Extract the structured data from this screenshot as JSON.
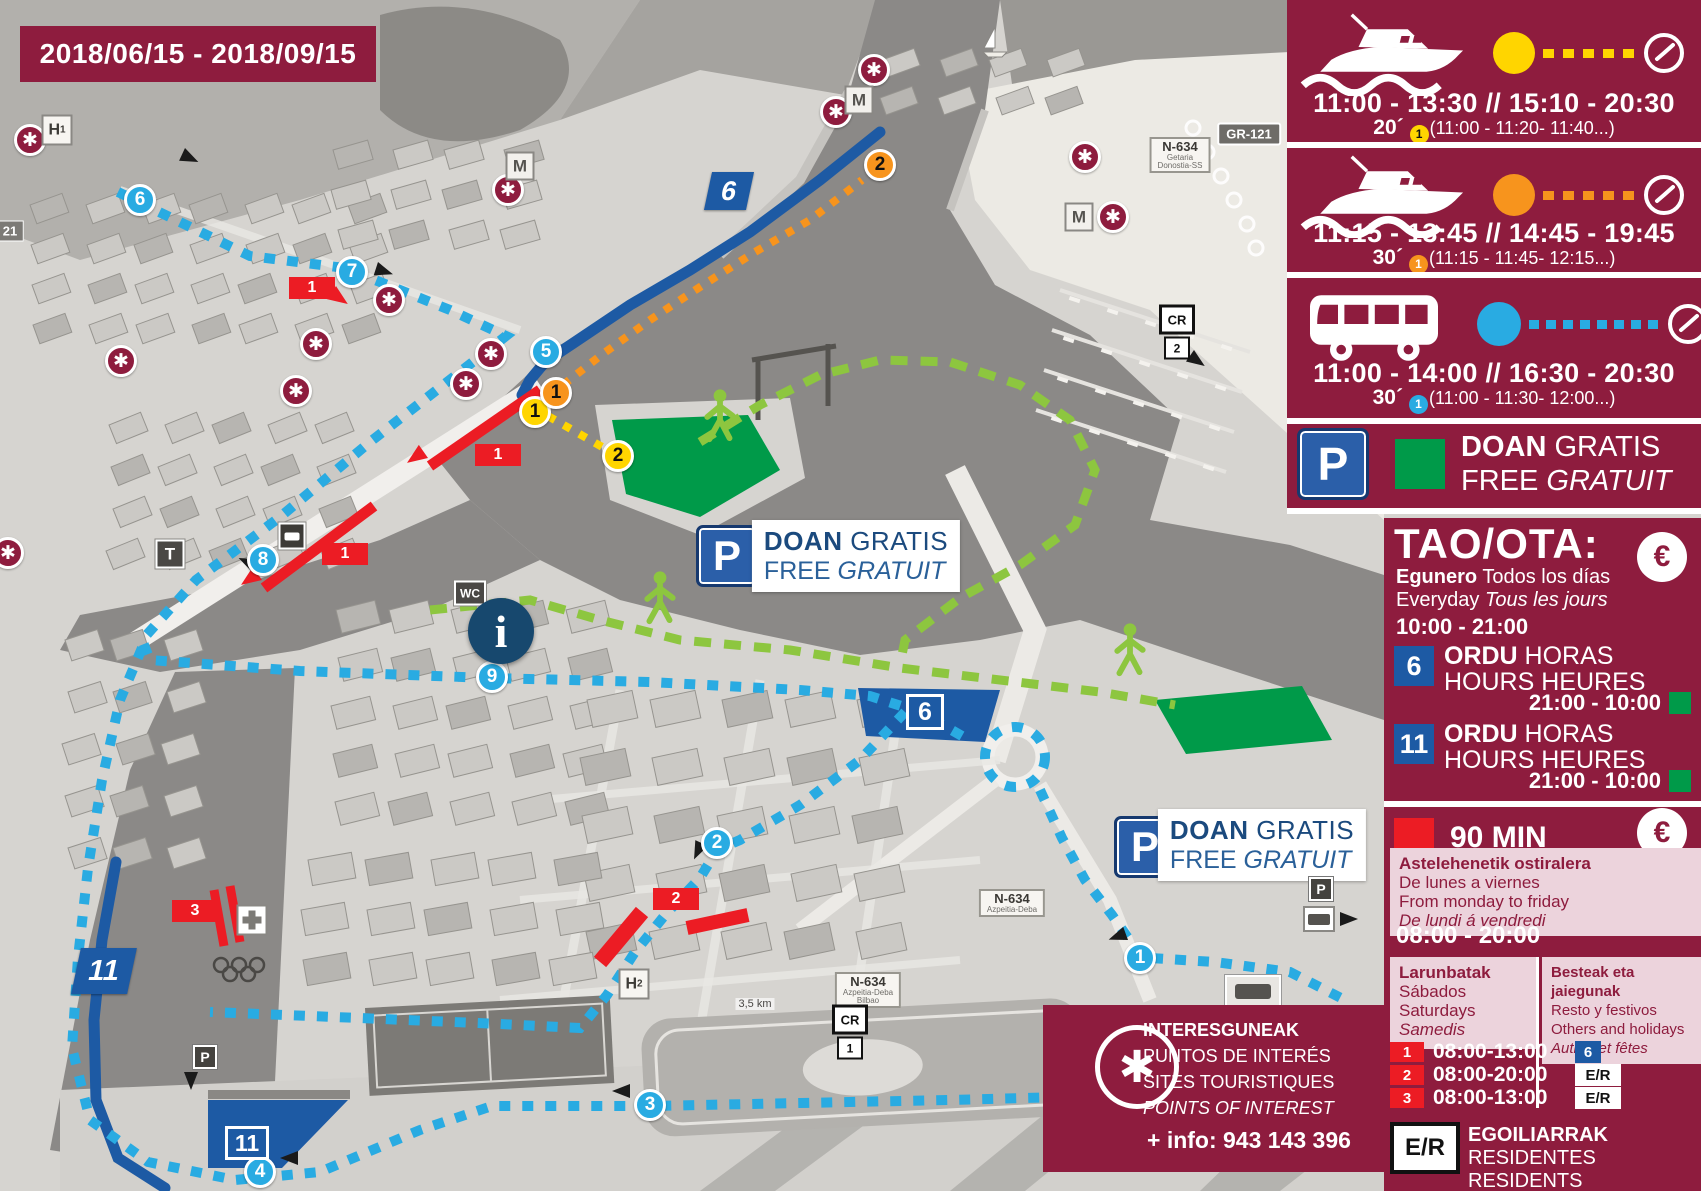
{
  "colors": {
    "maroon": "#8e1c3e",
    "yellow": "#ffd500",
    "orange": "#f7941d",
    "blue": "#29abe2",
    "navy": "#1d5aa4",
    "green": "#009a49",
    "red": "#ec1c24",
    "pink": "#ecd3dc"
  },
  "date_range": "2018/06/15 - 2018/09/15",
  "sidebar": {
    "boat1": {
      "schedule": "11:00 - 13:30 // 15:10 - 20:30",
      "frequency": "20´",
      "frequency_detail": "(11:00 - 11:20- 11:40...)",
      "frequency_stop": "1"
    },
    "boat2": {
      "schedule": "11:15 - 13:45 // 14:45 - 19:45",
      "frequency": "30´",
      "frequency_detail": "(11:15 - 11:45- 12:15...)",
      "frequency_stop": "1"
    },
    "bus": {
      "schedule": "11:00 - 14:00 // 16:30 - 20:30",
      "frequency": "30´",
      "frequency_detail": "(11:00 - 11:30- 12:00...)",
      "frequency_stop": "1"
    },
    "free_parking": {
      "doan": "DOAN",
      "gratis": " GRATIS",
      "free": "FREE ",
      "gratuit": "GRATUIT"
    },
    "tao": {
      "title": "TAO/OTA:",
      "euro": "€",
      "line1_bold": "Egunero",
      "line1": " Todos los días",
      "line2": "Everyday ",
      "line2_italic": "Tous les jours",
      "day_hours": "10:00 - 21:00",
      "zones": [
        {
          "number": "6",
          "ordu": "ORDU",
          "horas": " HORAS",
          "hours": "HOURS ",
          "heures": "HEURES",
          "night_hours": "21:00 - 10:00"
        },
        {
          "number": "11",
          "ordu": "ORDU",
          "horas": " HORAS",
          "hours": "HOURS ",
          "heures": "HEURES",
          "night_hours": "21:00 - 10:00"
        }
      ]
    },
    "min90": {
      "label": "90 MIN",
      "euro": "€",
      "weekdays_bold": "Astelehenetik ostiralera",
      "weekdays": [
        "De lunes a viernes",
        "From monday to friday"
      ],
      "weekdays_italic": "De lundi á vendredi",
      "weekday_hours": "08:00 - 20:00",
      "saturdays_bold": "Larunbatak",
      "saturdays": [
        "Sábados",
        "Saturdays"
      ],
      "saturdays_italic": "Samedis",
      "holidays_bold": "Besteak eta jaiegunak",
      "holidays": [
        "Resto y festivos",
        "Others and holidays"
      ],
      "holidays_italic": "Autres et fêtes",
      "zone_rows": [
        {
          "zone": "1",
          "hours": "08:00-13:00",
          "tag": "6",
          "tag_style": "blue"
        },
        {
          "zone": "2",
          "hours": "08:00-20:00",
          "tag": "E/R",
          "tag_style": "white"
        },
        {
          "zone": "3",
          "hours": "08:00-13:00",
          "tag": "E/R",
          "tag_style": "white"
        }
      ]
    },
    "residents": {
      "badge": "E/R",
      "line1_bold": "EGOILIARRAK",
      "line1": " RESIDENTES",
      "line2": "RESIDENTS ONLY",
      "line2_italic": "RÉSIDENTS"
    }
  },
  "poi_panel": {
    "asterisk": "✱",
    "title": "INTERESGUNEAK",
    "line2": "PUNTOS DE INTERÉS",
    "line3": "SITES TOURISTIQUES",
    "line4": "POINTS OF INTEREST",
    "info": "+ info: 943 143 396"
  },
  "map": {
    "markers": [
      {
        "type": "stop",
        "color": "blue",
        "label": "1",
        "x": 1140,
        "y": 958
      },
      {
        "type": "stop",
        "color": "blue",
        "label": "2",
        "x": 717,
        "y": 843
      },
      {
        "type": "stop",
        "color": "blue",
        "label": "3",
        "x": 650,
        "y": 1105
      },
      {
        "type": "stop",
        "color": "blue",
        "label": "4",
        "x": 260,
        "y": 1172
      },
      {
        "type": "stop",
        "color": "blue",
        "label": "5",
        "x": 546,
        "y": 352
      },
      {
        "type": "stop",
        "color": "blue",
        "label": "6",
        "x": 140,
        "y": 200
      },
      {
        "type": "stop",
        "color": "blue",
        "label": "7",
        "x": 352,
        "y": 272
      },
      {
        "type": "stop",
        "color": "blue",
        "label": "8",
        "x": 263,
        "y": 560
      },
      {
        "type": "stop",
        "color": "blue",
        "label": "9",
        "x": 492,
        "y": 677
      },
      {
        "type": "stop",
        "color": "yellow",
        "label": "1",
        "x": 535,
        "y": 412
      },
      {
        "type": "stop",
        "color": "yellow",
        "label": "2",
        "x": 618,
        "y": 456
      },
      {
        "type": "stop",
        "color": "orange",
        "label": "1",
        "x": 556,
        "y": 393
      },
      {
        "type": "stop",
        "color": "orange",
        "label": "2",
        "x": 880,
        "y": 165
      },
      {
        "type": "redbox",
        "label": "1",
        "x": 312,
        "y": 288
      },
      {
        "type": "redbox",
        "label": "1",
        "x": 498,
        "y": 455
      },
      {
        "type": "redbox",
        "label": "1",
        "x": 345,
        "y": 554
      },
      {
        "type": "redbox",
        "label": "2",
        "x": 676,
        "y": 899
      },
      {
        "type": "redbox",
        "label": "3",
        "x": 195,
        "y": 911
      },
      {
        "type": "poi",
        "x": 30,
        "y": 140
      },
      {
        "type": "poi",
        "x": 874,
        "y": 70
      },
      {
        "type": "poi",
        "x": 836,
        "y": 112
      },
      {
        "type": "poi",
        "x": 1085,
        "y": 157
      },
      {
        "type": "poi",
        "x": 1113,
        "y": 217
      },
      {
        "type": "poi",
        "x": 508,
        "y": 190
      },
      {
        "type": "poi",
        "x": 389,
        "y": 300
      },
      {
        "type": "poi",
        "x": 121,
        "y": 361
      },
      {
        "type": "poi",
        "x": 316,
        "y": 344
      },
      {
        "type": "poi",
        "x": 296,
        "y": 391
      },
      {
        "type": "poi",
        "x": 491,
        "y": 354
      },
      {
        "type": "poi",
        "x": 466,
        "y": 384
      },
      {
        "type": "poi",
        "x": 8,
        "y": 553
      },
      {
        "type": "sq",
        "label": "M",
        "x": 520,
        "y": 166
      },
      {
        "type": "sq",
        "label": "M",
        "x": 859,
        "y": 100
      },
      {
        "type": "sq",
        "label": "M",
        "x": 1079,
        "y": 217
      },
      {
        "type": "hsign",
        "label": "H",
        "sub": "1",
        "x": 57,
        "y": 130
      },
      {
        "type": "hsign",
        "label": "H",
        "sub": "2",
        "x": 634,
        "y": 984
      },
      {
        "type": "darksq",
        "label": "T",
        "x": 170,
        "y": 554
      },
      {
        "type": "wc",
        "label": "WC",
        "x": 470,
        "y": 593
      },
      {
        "type": "busstop",
        "x": 292,
        "y": 536
      },
      {
        "type": "info",
        "label": "i",
        "x": 501,
        "y": 631
      },
      {
        "type": "pbig",
        "label": "P",
        "x": 727,
        "y": 556
      },
      {
        "type": "plabel",
        "line1_bold": "DOAN",
        "line1": " GRATIS",
        "line2": "FREE ",
        "line2_italic": "GRATUIT",
        "x": 856,
        "y": 556
      },
      {
        "type": "pbig",
        "label": "P",
        "x": 1145,
        "y": 847
      },
      {
        "type": "plabel",
        "line1_bold": "DOAN",
        "line1": " GRATIS",
        "line2": "FREE ",
        "line2_italic": "GRATUIT",
        "x": 1262,
        "y": 845
      },
      {
        "type": "psmall",
        "label": "P",
        "x": 1321,
        "y": 889
      },
      {
        "type": "psmall",
        "label": "P",
        "x": 205,
        "y": 1057
      },
      {
        "type": "camper",
        "x": 1319,
        "y": 919
      },
      {
        "type": "station",
        "x": 1253,
        "y": 991
      },
      {
        "type": "flag",
        "variant": "f6",
        "label": "6",
        "x": 729,
        "y": 191
      },
      {
        "type": "zonebox",
        "variant": "f6",
        "label": "6",
        "x": 925,
        "y": 712
      },
      {
        "type": "flag",
        "variant": "f11",
        "label": "11",
        "x": 104,
        "y": 971
      },
      {
        "type": "zonebox",
        "variant": "f11",
        "label": "11",
        "x": 247,
        "y": 1143
      },
      {
        "type": "roaddark",
        "label": "GR-121",
        "x": 1249,
        "y": 134
      },
      {
        "type": "roadwhite",
        "label": "N-634",
        "sub": [
          "Getaria",
          "Donostia-SS"
        ],
        "x": 1180,
        "y": 155
      },
      {
        "type": "roadwhite",
        "label": "N-634",
        "sub": [
          "Azpeitia-Deba",
          "Bilbao"
        ],
        "x": 868,
        "y": 990
      },
      {
        "type": "roadwhite",
        "label": "N-634",
        "sub": [
          "Azpeitia-Deba"
        ],
        "x": 1012,
        "y": 903
      },
      {
        "type": "cr",
        "label": "CR",
        "num": "2",
        "x": 1177,
        "y": 332
      },
      {
        "type": "cr",
        "label": "CR",
        "num": "1",
        "x": 850,
        "y": 1032
      },
      {
        "type": "tag21",
        "label": "21",
        "x": 10,
        "y": 231
      },
      {
        "type": "km",
        "label": "3,5 km",
        "x": 755,
        "y": 1004
      },
      {
        "type": "walker",
        "x": 720,
        "y": 418
      },
      {
        "type": "walker",
        "x": 660,
        "y": 600
      },
      {
        "type": "walker",
        "x": 1130,
        "y": 652
      },
      {
        "type": "sailboat",
        "x": 995,
        "y": 42
      },
      {
        "type": "olympic",
        "x": 239,
        "y": 970
      },
      {
        "type": "aid",
        "x": 252,
        "y": 920
      }
    ]
  }
}
